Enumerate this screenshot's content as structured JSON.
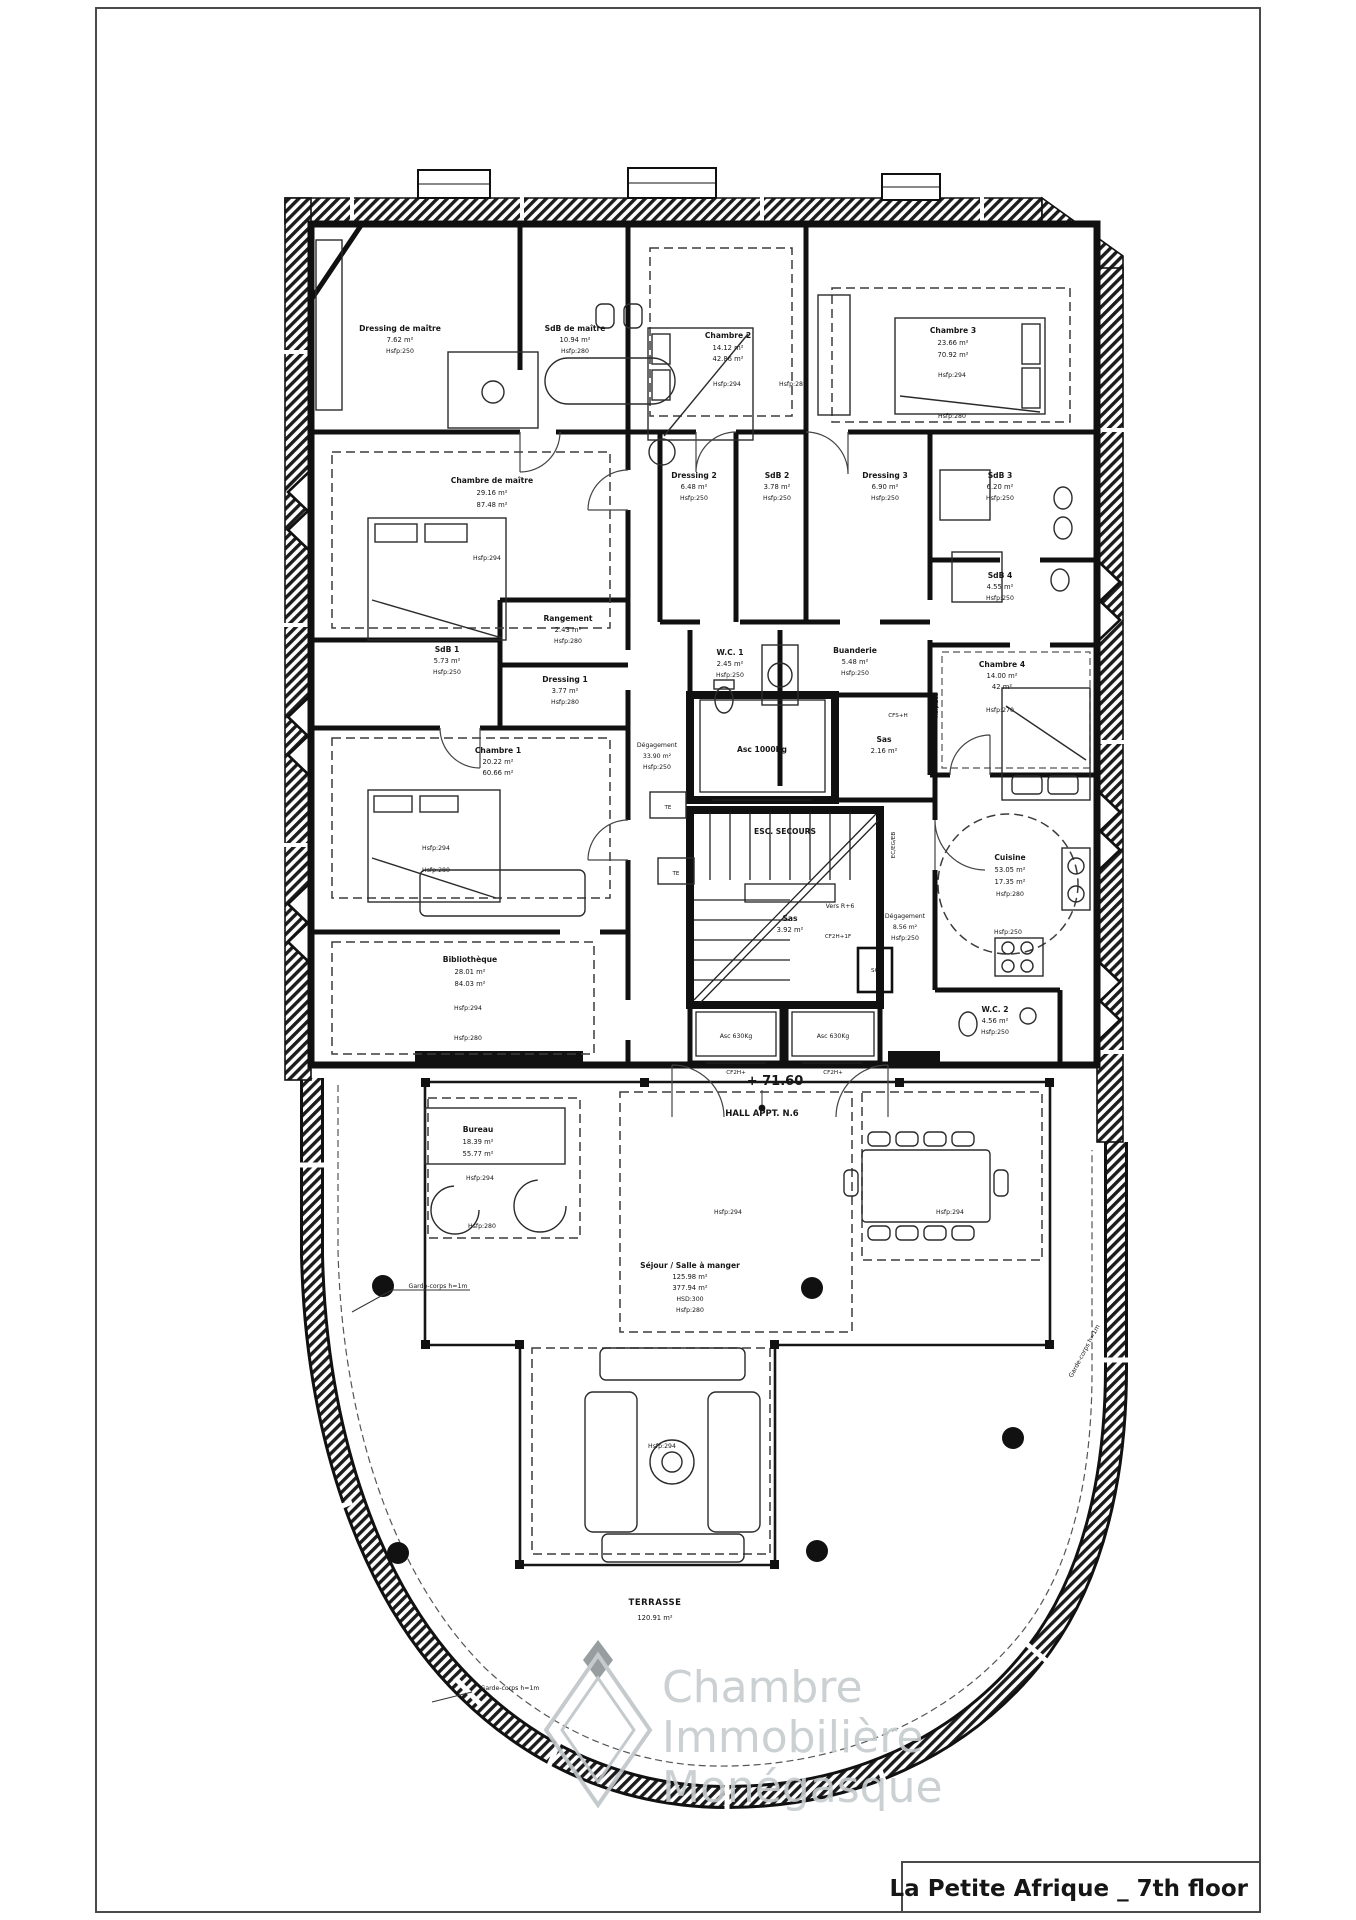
{
  "sheet": {
    "title": "La Petite Afrique _ 7th floor"
  },
  "watermark": [
    "Chambre",
    "Immobilière",
    "Monégasque"
  ],
  "level": {
    "elevation": "+ 71.60",
    "hall": "HALL APPT. N.6"
  },
  "rooms": {
    "dressing_maitre": [
      "Dressing de maître",
      "7.62 m²",
      "Hsfp:250"
    ],
    "sdb_maitre": [
      "SdB de maître",
      "10.94 m²",
      "Hsfp:280"
    ],
    "chambre_2": [
      "Chambre 2",
      "14.12 m²",
      "42.86 m²",
      "Hsfp:294",
      "Hsfp:280"
    ],
    "chambre_3": [
      "Chambre 3",
      "23.66 m²",
      "70.92 m²",
      "Hsfp:294",
      "Hsfp:280"
    ],
    "chambre_maitre": [
      "Chambre de maître",
      "29.16 m²",
      "87.48 m²",
      "Hsfp:294"
    ],
    "dressing_2": [
      "Dressing 2",
      "6.48 m²",
      "Hsfp:250"
    ],
    "sdb_2": [
      "SdB 2",
      "3.78 m²",
      "Hsfp:250"
    ],
    "dressing_3": [
      "Dressing 3",
      "6.90 m²",
      "Hsfp:250"
    ],
    "sdb_3": [
      "SdB 3",
      "6.20 m²",
      "Hsfp:250"
    ],
    "sdb_4": [
      "SdB 4",
      "4.55 m²",
      "Hsfp:250"
    ],
    "rangement": [
      "Rangement",
      "2.43 m²",
      "Hsfp:280"
    ],
    "dressing_1": [
      "Dressing 1",
      "3.77 m²",
      "Hsfp:280"
    ],
    "wc_1": [
      "W.C. 1",
      "2.45 m²",
      "Hsfp:250"
    ],
    "buanderie": [
      "Buanderie",
      "5.48 m²",
      "Hsfp:250"
    ],
    "chambre_4": [
      "Chambre 4",
      "14.00 m²",
      "42 m²",
      "Hsfp:270"
    ],
    "sdb_1": [
      "SdB 1",
      "5.73 m²",
      "Hsfp:250"
    ],
    "chambre_1": [
      "Chambre 1",
      "20.22 m²",
      "60.66 m²",
      "Hsfp:294",
      "Hsfp:280"
    ],
    "degagement": [
      "Dégagement",
      "33.90 m²",
      "Hsfp:250"
    ],
    "asc_1000": [
      "Asc 1000Kg"
    ],
    "sas_1": [
      "Sas",
      "2.16 m²"
    ],
    "esc_secours": [
      "ESC. SECOURS",
      "Vers R+6"
    ],
    "cuisine": [
      "Cuisine",
      "53.05 m²",
      "17.35 m²",
      "Hsfp:280",
      "Hsfp:250"
    ],
    "bibliotheque": [
      "Bibliothèque",
      "28.01 m²",
      "84.03 m²",
      "Hsfp:294",
      "Hsfp:280"
    ],
    "sas_2": [
      "Sas",
      "3.92 m²"
    ],
    "degagement_2": [
      "Dégagement",
      "8.56 m²",
      "Hsfp:250"
    ],
    "asc_630_a": [
      "Asc 630Kg"
    ],
    "asc_630_b": [
      "Asc 630Kg"
    ],
    "wc_2": [
      "W.C. 2",
      "4.56 m²",
      "Hsfp:250"
    ],
    "bureau": [
      "Bureau",
      "18.39 m²",
      "55.77 m²",
      "Hsfp:294",
      "Hsfp:280"
    ],
    "sejour": [
      "Séjour / Salle à manger",
      "125.98 m²",
      "377.94 m²",
      "HSD:300",
      "Hsfp:280"
    ],
    "terrasse": [
      "TERRASSE",
      "120.91 m²"
    ]
  },
  "zones": {
    "sejour_center": "Hsfp:294",
    "dining": "Hsfp:294",
    "sofa": "Hsfp:294"
  },
  "annotations": {
    "garde_corps": "Garde-corps h=1m",
    "te": "TE",
    "sg": "SG",
    "cf2h_1f": "CF2H+1F",
    "cfs_h": "CFS+H",
    "cf2h": "CF2H+",
    "ec_eg_eb": "EC/EG/EB",
    "hsfp285": "Hsfp:285"
  }
}
